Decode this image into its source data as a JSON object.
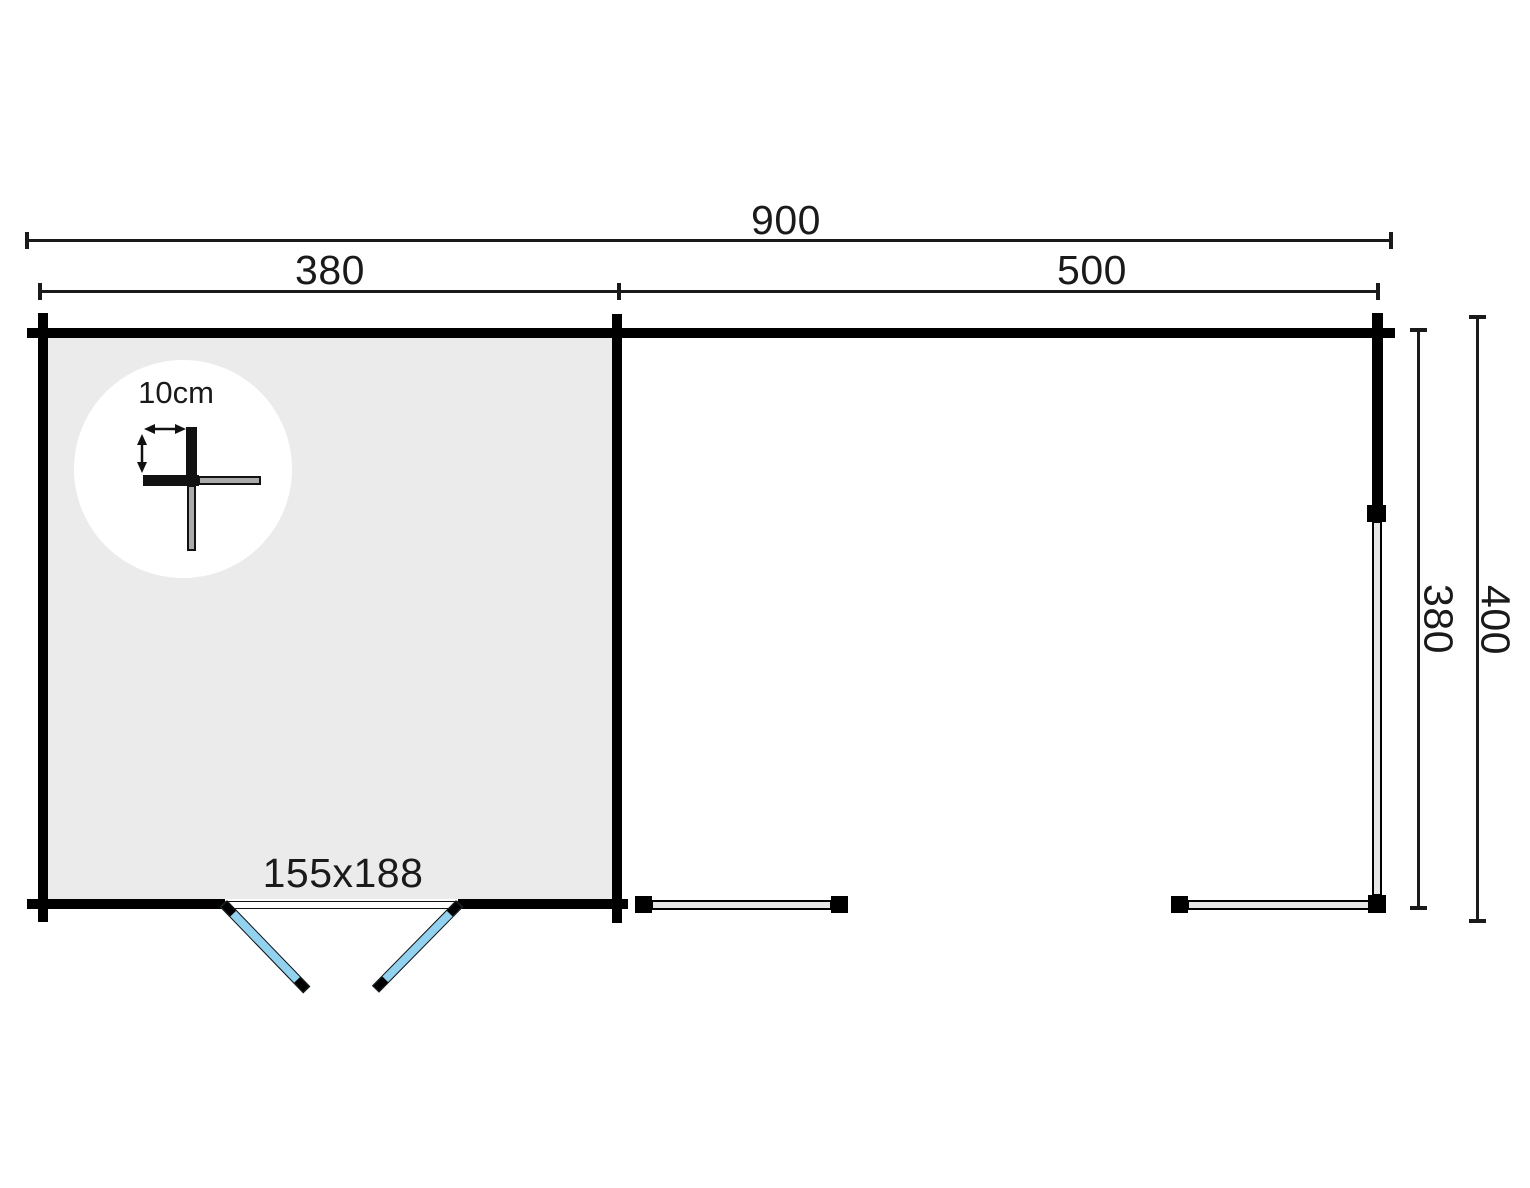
{
  "colors": {
    "background": "#ffffff",
    "wall": "#000000",
    "room_fill": "#ebebeb",
    "door": "#93d2ef",
    "beam_fill": "#e6e6e6",
    "detail_gray": "#aaaaaa"
  },
  "dimensions": {
    "overall_width": "900",
    "room_width": "380",
    "veranda_width": "500",
    "depth_inner": "380",
    "depth_outer": "400"
  },
  "door": {
    "size": "155x188"
  },
  "detail": {
    "log_thickness": "10cm"
  }
}
